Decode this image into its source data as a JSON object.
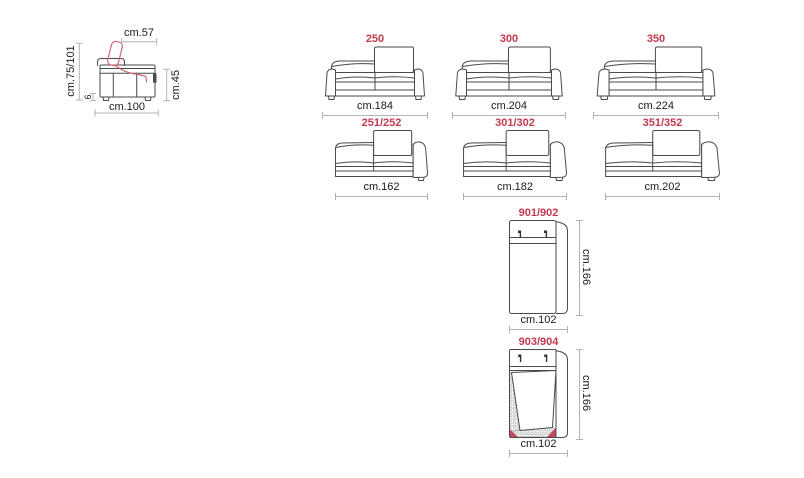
{
  "palette": {
    "accent_red": "#c23a50",
    "headrest_red": "#d0697a",
    "drawing_line": "#4a4a4a",
    "dimension_line": "#b3b3b3"
  },
  "side_view": {
    "headrest_width": "cm.57",
    "total_height": "cm.75/101",
    "foot_height": "6",
    "seat_height": "cm.45",
    "depth": "cm.100"
  },
  "models": [
    {
      "code": "250",
      "width": "cm.184"
    },
    {
      "code": "300",
      "width": "cm.204"
    },
    {
      "code": "350",
      "width": "cm.224"
    },
    {
      "code": "251/252",
      "width": "cm.162"
    },
    {
      "code": "301/302",
      "width": "cm.182"
    },
    {
      "code": "351/352",
      "width": "cm.202"
    },
    {
      "code": "901/902",
      "width": "cm.102",
      "height": "cm.166"
    },
    {
      "code": "903/904",
      "width": "cm.102",
      "height": "cm.166"
    }
  ]
}
